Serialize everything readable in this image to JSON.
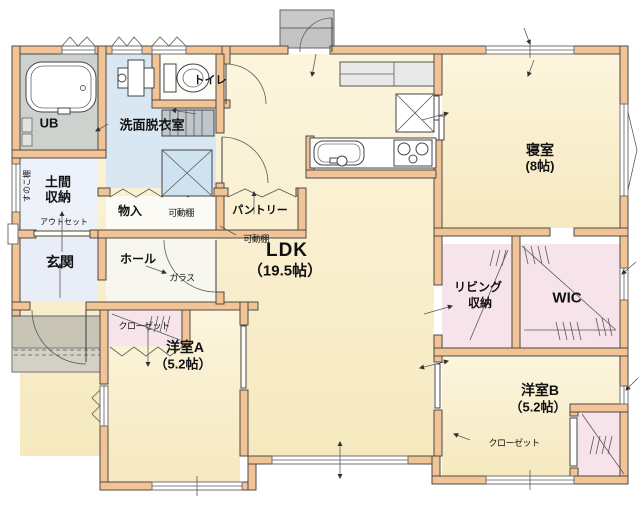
{
  "title": "間取り図（平面図）",
  "colors": {
    "wall": "#F2C394",
    "floor_main": "#FAF0D2",
    "floor_wet": "#D9E7F2",
    "floor_entry": "#E9EDF7",
    "floor_storage": "#F7E3EA",
    "floor_bath": "#CDD2CE",
    "porch": "#C8C5B6",
    "line": "#4A4A4A"
  },
  "rooms": {
    "ub": {
      "label": "UB"
    },
    "washroom": {
      "label": "洗面脱衣室"
    },
    "toilet": {
      "label": "トイレ"
    },
    "doma": {
      "line1": "土間",
      "line2": "収納",
      "shelf": "すのこ棚"
    },
    "outset": {
      "label": "アウトセット"
    },
    "genkan": {
      "label": "玄関"
    },
    "hall": {
      "label": "ホール"
    },
    "monoire": {
      "label": "物入",
      "shelf": "可動棚"
    },
    "pantry": {
      "label": "パントリー",
      "shelf": "可動棚"
    },
    "ldk": {
      "label": "LDK",
      "size": "（19.5帖）"
    },
    "glass_door": {
      "label": "ガラス"
    },
    "bedroom": {
      "label": "寝室",
      "size": "(8帖)"
    },
    "living_storage": {
      "line1": "リビング",
      "line2": "収納"
    },
    "wic": {
      "label": "WIC"
    },
    "room_a": {
      "label": "洋室A",
      "size": "（5.2帖）",
      "closet": "クローゼット"
    },
    "room_b": {
      "label": "洋室B",
      "size": "（5.2帖）",
      "closet": "クローゼット"
    }
  }
}
